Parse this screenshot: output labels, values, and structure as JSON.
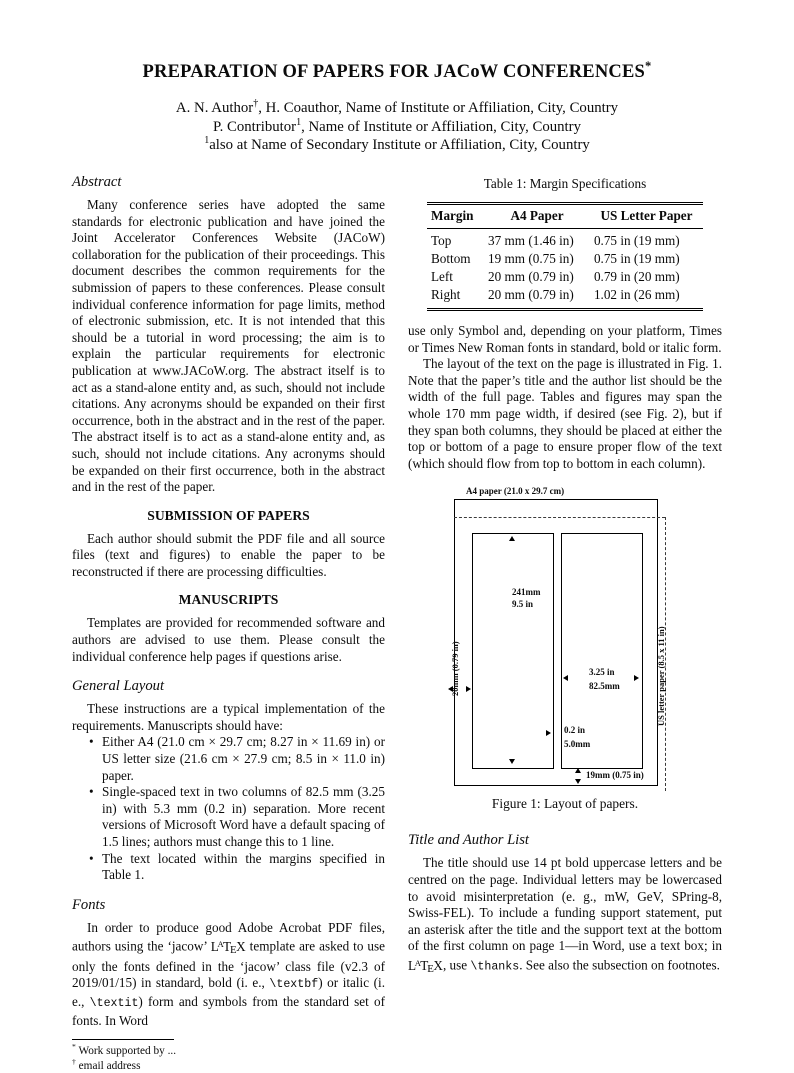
{
  "header": {
    "title": "PREPARATION OF PAPERS FOR JACoW CONFERENCES",
    "title_marker": "*",
    "author_lines": [
      [
        {
          "t": "A. N. Author"
        },
        {
          "t": "†",
          "s": "sup"
        },
        {
          "t": ", H. Coauthor, Name of Institute or Affiliation, City, Country"
        }
      ],
      [
        {
          "t": "P. Contributor"
        },
        {
          "t": "1",
          "s": "sup"
        },
        {
          "t": ", Name of Institute or Affiliation, City, Country"
        }
      ],
      [
        {
          "t": "1",
          "s": "sup"
        },
        {
          "t": "also at Name of Secondary Institute or Affiliation, City, Country"
        }
      ]
    ]
  },
  "left": {
    "abstract": {
      "heading": "Abstract",
      "body": "Many conference series have adopted the same standards for electronic publication and have joined the Joint Accelerator Conferences Website (JACoW) collaboration for the publication of their proceedings. This document describes the common requirements for the submission of papers to these conferences. Please consult individual conference information for page limits, method of electronic submission, etc. It is not intended that this should be a tutorial in word processing; the aim is to explain the particular requirements for electronic publication at www.JACoW.org. The abstract itself is to act as a stand-alone entity and, as such, should not include citations. Any acronyms should be expanded on their first occurrence, both in the abstract and in the rest of the paper. The abstract itself is to act as a stand-alone entity and, as such, should not include citations. Any acronyms should be expanded on their first occurrence, both in the abstract and in the rest of the paper."
    },
    "submission": {
      "heading": "SUBMISSION OF PAPERS",
      "body": "Each author should submit the PDF file and all source files (text and figures) to enable the paper to be reconstructed if there are processing difficulties."
    },
    "manuscripts": {
      "heading": "MANUSCRIPTS",
      "body": "Templates are provided for recommended software and authors are advised to use them. Please consult the individual conference help pages if questions arise."
    },
    "general_layout": {
      "heading": "General Layout",
      "intro": "These instructions are a typical implementation of the requirements. Manuscripts should have:",
      "bullets": [
        "Either A4 (21.0 cm × 29.7 cm; 8.27 in × 11.69 in) or US letter size (21.6 cm × 27.9 cm; 8.5 in × 11.0 in) paper.",
        "Single-spaced text in two columns of 82.5 mm (3.25 in) with 5.3 mm (0.2 in) separation. More recent versions of Microsoft Word have a default spacing of 1.5 lines; authors must change this to 1 line.",
        "The text located within the margins specified in Table 1."
      ]
    },
    "fonts": {
      "heading": "Fonts",
      "body_segments": [
        {
          "t": "In order to produce good Adobe Acrobat PDF files, authors using the ‘jacow’ "
        },
        {
          "t": "LaTeX",
          "s": "latex"
        },
        {
          "t": " template are asked to use only the fonts defined in the ‘jacow’ class file (v2.3 of 2019/01/15) in standard, bold (i. e., "
        },
        {
          "t": "\\textbf",
          "s": "mono"
        },
        {
          "t": ") or italic (i. e., "
        },
        {
          "t": "\\textit",
          "s": "mono"
        },
        {
          "t": ") form and symbols from the standard set of fonts. In Word"
        }
      ]
    },
    "footnotes": [
      [
        {
          "t": "*",
          "s": "sup"
        },
        {
          "t": " Work supported by ..."
        }
      ],
      [
        {
          "t": "†",
          "s": "sup"
        },
        {
          "t": " email address"
        }
      ]
    ]
  },
  "right": {
    "table": {
      "caption": "Table 1: Margin Specifications",
      "headers": [
        "Margin",
        "A4 Paper",
        "US Letter Paper"
      ],
      "rows": [
        [
          "Top",
          "37 mm (1.46 in)",
          "0.75 in (19 mm)"
        ],
        [
          "Bottom",
          "19 mm (0.75 in)",
          "0.75 in (19 mm)"
        ],
        [
          "Left",
          "20 mm (0.79 in)",
          "0.79 in (20 mm)"
        ],
        [
          "Right",
          "20 mm (0.79 in)",
          "1.02 in (26 mm)"
        ]
      ]
    },
    "para_continuation": "use only Symbol and, depending on your platform, Times or Times New Roman fonts in standard, bold or italic form.",
    "para_layout": "The layout of the text on the page is illustrated in Fig. 1. Note that the paper’s title and the author list should be the width of the full page. Tables and figures may span the whole 170 mm page width, if desired (see Fig. 2), but if they span both columns, they should be placed at either the top or bottom of a page to ensure proper flow of the text (which should flow from top to bottom in each column).",
    "figure": {
      "a4_label": "A4 paper (21.0 x 29.7 cm)",
      "col_height_line1": "241mm",
      "col_height_line2": "9.5 in",
      "col_width_line1": "3.25 in",
      "col_width_line2": "82.5mm",
      "gap_line1": "0.2 in",
      "gap_line2": "5.0mm",
      "bottom_margin": "19mm (0.75 in)",
      "left_margin": "20mm (0.79 in)",
      "us_letter": "US letter paper (8.5 x 11 in)",
      "caption": "Figure 1: Layout of papers."
    },
    "title_author": {
      "heading": "Title and Author List",
      "body_segments": [
        {
          "t": "The title should use 14 pt bold uppercase letters and be centred on the page. Individual letters may be lowercased to avoid misinterpretation (e. g., mW, GeV, SPring-8, Swiss-FEL). To include a funding support statement, put an asterisk after the title and the support text at the bottom of the first column on page 1—in Word, use a text box; in "
        },
        {
          "t": "LaTeX",
          "s": "latex"
        },
        {
          "t": ", use "
        },
        {
          "t": "\\thanks",
          "s": "mono"
        },
        {
          "t": ". See also the subsection on footnotes."
        }
      ]
    }
  }
}
